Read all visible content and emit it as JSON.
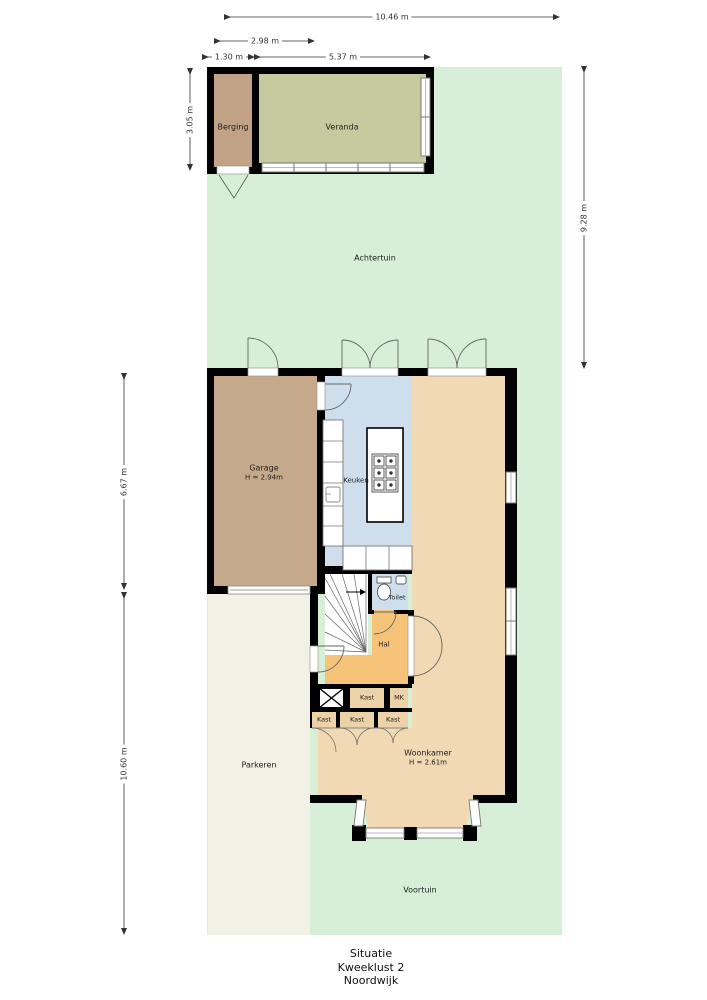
{
  "title_block": {
    "line1": "Situatie",
    "line2": "Kweeklust 2",
    "line3": "Noordwijk"
  },
  "rooms": {
    "achtertuin": "Achtertuin",
    "voortuin": "Voortuin",
    "parkeren": "Parkeren",
    "berging": "Berging",
    "veranda": "Veranda",
    "garage": {
      "name": "Garage",
      "height": "H = 2.94m"
    },
    "keuken": "Keuken",
    "toilet": "Toilet",
    "hal": "Hal",
    "kast": "Kast",
    "mk": "MK",
    "woonkamer": {
      "name": "Woonkamer",
      "height": "H = 2.61m"
    }
  },
  "dimensions": {
    "d1046": "10.46 m",
    "d298": "2.98 m",
    "d130": "1.30 m",
    "d537": "5.37 m",
    "d305": "3.05 m",
    "d667": "6.67 m",
    "d1060": "10.60 m",
    "d928": "9.28 m"
  },
  "colors": {
    "garden": "#d6efd6",
    "parkeren": "#f2f1e5",
    "berging": "#c2a284",
    "veranda": "#c7c99e",
    "garage": "#c6a98a",
    "keuken": "#cfdeed",
    "toilet": "#cfdeed",
    "hal": "#f6c479",
    "woonkamer": "#f0d9b3",
    "kast": "#ecd2a6",
    "wall": "#000000"
  }
}
